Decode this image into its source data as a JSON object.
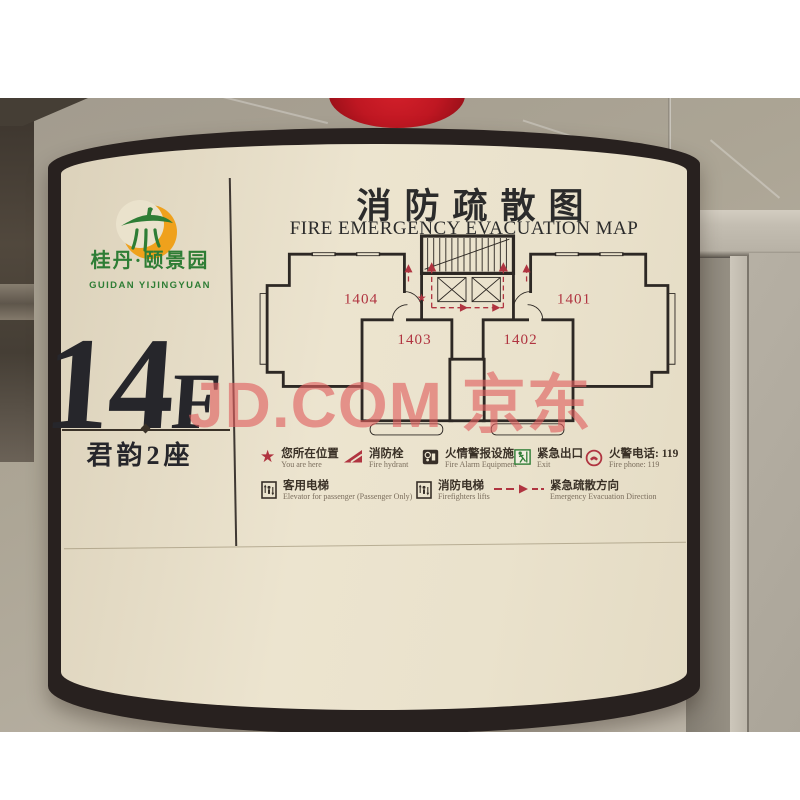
{
  "photo": {
    "watermark_text": "JD.COM 京东",
    "colors": {
      "wall": "#aca595",
      "sign_face": "#eae2cc",
      "sign_border": "#28211f",
      "ball_red": "#bf1722",
      "logo_green": "#2e7d35",
      "logo_orange": "#efa11c",
      "plan_ink": "#2d2824",
      "plan_red": "#b03440",
      "watermark_red": "#e05f5f",
      "ink": "#26262b"
    }
  },
  "sign": {
    "brand": {
      "name_cn": "桂丹·颐景园",
      "name_en": "GUIDAN YIJINGYUAN"
    },
    "floor": {
      "number": "14",
      "suffix": "F",
      "building_label": "君韵2座"
    },
    "title_cn": "消防疏散图",
    "title_en": "FIRE EMERGENCY EVACUATION MAP"
  },
  "floor_plan": {
    "star_glyph": "★",
    "units": [
      {
        "id": "1404"
      },
      {
        "id": "1403"
      },
      {
        "id": "1402"
      },
      {
        "id": "1401"
      }
    ]
  },
  "legend": {
    "row1": [
      {
        "icon": "you-are-here-star",
        "glyph": "★",
        "cn": "您所在位置",
        "en": "You are here"
      },
      {
        "icon": "fire-hydrant",
        "cn": "消防栓",
        "en": "Fire hydrant"
      },
      {
        "icon": "fire-alarm",
        "cn": "火情警报设施",
        "en": "Fire Alarm Equipment"
      },
      {
        "icon": "exit",
        "cn": "紧急出口",
        "en": "Exit"
      },
      {
        "icon": "fire-phone",
        "cn": "火警电话: 119",
        "en": "Fire phone: 119"
      }
    ],
    "row2": [
      {
        "icon": "passenger-elevator",
        "cn": "客用电梯",
        "en": "Elevator for passenger (Passenger Only)"
      },
      {
        "icon": "firefighter-elevator",
        "cn": "消防电梯",
        "en": "Firefighters lifts"
      },
      {
        "icon": "evacuation-direction",
        "cn": "紧急疏散方向",
        "en": "Emergency Evacuation Direction"
      }
    ]
  }
}
